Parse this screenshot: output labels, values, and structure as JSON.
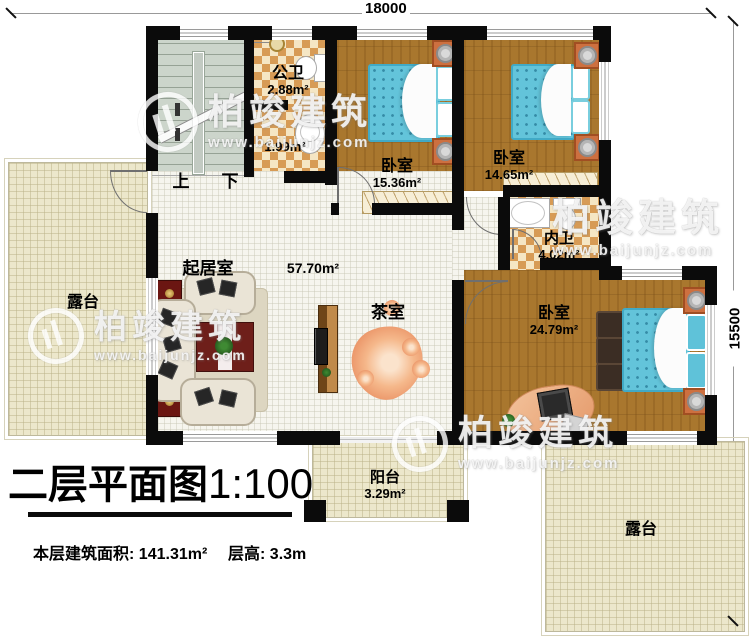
{
  "dimensions": {
    "width": "18000",
    "height": "15500"
  },
  "title": {
    "name": "二层平面图",
    "scale": "1:100"
  },
  "footer": {
    "area_label": "本层建筑面积:",
    "area_value": "141.31m²",
    "floor_height_label": "层高:",
    "floor_height_value": "3.3m"
  },
  "stairs": {
    "up": "上",
    "down": "下"
  },
  "rooms": {
    "public_bath": {
      "name": "公卫",
      "area": "2.88m²"
    },
    "wash_area": {
      "area": "1.99m²"
    },
    "bedroom1": {
      "name": "卧室",
      "area": "15.36m²"
    },
    "bedroom2": {
      "name": "卧室",
      "area": "14.65m²"
    },
    "ensuite_bath": {
      "name": "内卫",
      "area": "4.02m²"
    },
    "master_bedroom": {
      "name": "卧室",
      "area": "24.79m²"
    },
    "living_room": {
      "name": "起居室",
      "area": "57.70m²"
    },
    "tea_room": {
      "name": "茶室"
    },
    "balcony": {
      "name": "阳台",
      "area": "3.29m²"
    },
    "terrace_left": {
      "name": "露台"
    },
    "terrace_right": {
      "name": "露台"
    }
  },
  "watermark": {
    "brand": "柏竣建筑",
    "url": "www.baijunjz.com"
  },
  "colors": {
    "wall": "#0b0b0b",
    "wood_floor": "#a9772e",
    "bath_tile": "#d79b55",
    "terrace_floor": "#ece7cb",
    "mattress_blue": "#63c4da",
    "cabinet_red": "#6b1612"
  }
}
